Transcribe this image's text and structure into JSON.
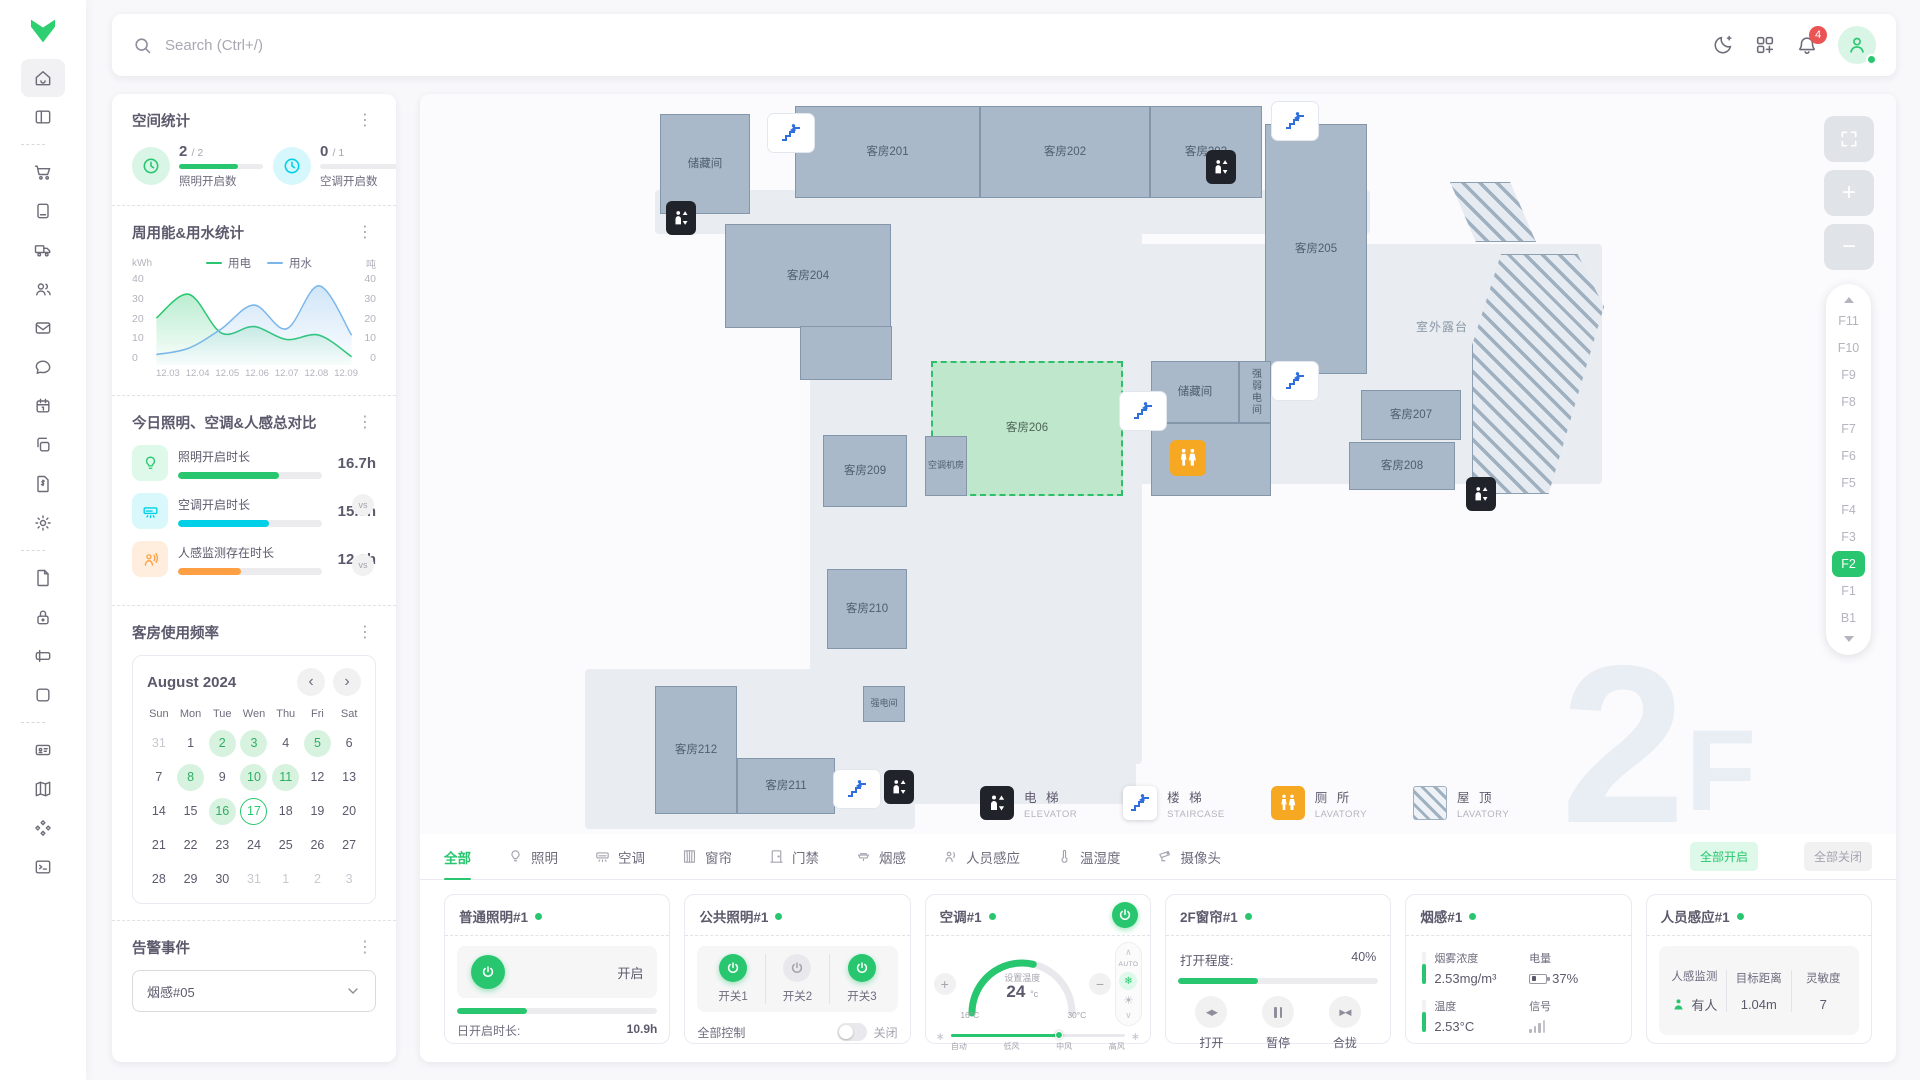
{
  "app": {
    "search_placeholder": "Search (Ctrl+/)",
    "notification_count": "4"
  },
  "sidebar": {
    "items": [
      {
        "icon": "home",
        "active": true
      },
      {
        "icon": "layout"
      },
      {
        "divider": true
      },
      {
        "icon": "cart"
      },
      {
        "icon": "book"
      },
      {
        "icon": "truck"
      },
      {
        "icon": "users"
      },
      {
        "icon": "mail"
      },
      {
        "icon": "chat"
      },
      {
        "icon": "calendar"
      },
      {
        "icon": "copy"
      },
      {
        "icon": "invoice"
      },
      {
        "icon": "gear"
      },
      {
        "divider": true
      },
      {
        "icon": "file"
      },
      {
        "icon": "lock"
      },
      {
        "icon": "input"
      },
      {
        "icon": "square"
      },
      {
        "divider": true
      },
      {
        "icon": "idcard"
      },
      {
        "icon": "map"
      },
      {
        "icon": "shapes"
      },
      {
        "icon": "terminal"
      }
    ]
  },
  "stats_panel": {
    "space_stats": {
      "title": "空间统计",
      "items": [
        {
          "value": "2",
          "denom": "/ 2",
          "label": "照明开启数",
          "color": "#28c76f",
          "pct": 70
        },
        {
          "value": "0",
          "denom": "/ 1",
          "label": "空调开启数",
          "color": "#00cfe8",
          "pct": 0
        }
      ]
    },
    "energy": {
      "title": "周用能&用水统计"
    },
    "compare": {
      "title": "今日照明、空调&人感总对比",
      "vs_label": "vs",
      "rows": [
        {
          "label": "照明开启时长",
          "value": "16.7h",
          "pct": 70,
          "color": "#28c76f",
          "icon": "bulb"
        },
        {
          "label": "空调开启时长",
          "value": "15.3h",
          "pct": 63,
          "color": "#00cfe8",
          "icon": "ac"
        },
        {
          "label": "人感监测存在时长",
          "value": "12.3h",
          "pct": 44,
          "color": "#ff9f43",
          "icon": "presence"
        }
      ]
    },
    "calendar": {
      "title": "客房使用频率",
      "month": "August 2024",
      "weekdays": [
        "Sun",
        "Mon",
        "Tue",
        "Wen",
        "Thu",
        "Fri",
        "Sat"
      ],
      "days": [
        {
          "n": "31",
          "s": "out"
        },
        {
          "n": "1"
        },
        {
          "n": "2",
          "s": "on"
        },
        {
          "n": "3",
          "s": "on"
        },
        {
          "n": "4"
        },
        {
          "n": "5",
          "s": "on"
        },
        {
          "n": "6"
        },
        {
          "n": "7"
        },
        {
          "n": "8",
          "s": "on"
        },
        {
          "n": "9"
        },
        {
          "n": "10",
          "s": "on"
        },
        {
          "n": "11",
          "s": "on"
        },
        {
          "n": "12"
        },
        {
          "n": "13"
        },
        {
          "n": "14"
        },
        {
          "n": "15"
        },
        {
          "n": "16",
          "s": "on"
        },
        {
          "n": "17",
          "s": "sel"
        },
        {
          "n": "18"
        },
        {
          "n": "19"
        },
        {
          "n": "20"
        },
        {
          "n": "21"
        },
        {
          "n": "22"
        },
        {
          "n": "23"
        },
        {
          "n": "24"
        },
        {
          "n": "25"
        },
        {
          "n": "26"
        },
        {
          "n": "27"
        },
        {
          "n": "28"
        },
        {
          "n": "29"
        },
        {
          "n": "30"
        },
        {
          "n": "31",
          "s": "out"
        },
        {
          "n": "1",
          "s": "out"
        },
        {
          "n": "2",
          "s": "out"
        },
        {
          "n": "3",
          "s": "out"
        }
      ]
    },
    "alarm": {
      "title": "告警事件",
      "selected": "烟感#05"
    }
  },
  "chart_data": {
    "type": "area",
    "title": "周用能&用水统计",
    "x": [
      "12.03",
      "12.04",
      "12.05",
      "12.06",
      "12.07",
      "12.08",
      "12.09"
    ],
    "series": [
      {
        "name": "用电",
        "color": "#28c76f",
        "values": [
          20,
          31,
          13,
          16,
          10,
          12,
          2
        ]
      },
      {
        "name": "用水",
        "color": "#7ab6ea",
        "values": [
          3,
          6,
          15,
          26,
          15,
          35,
          12
        ]
      }
    ],
    "ylabel_left": "kWh",
    "ylabel_right": "吨",
    "yticks": [
      0,
      10,
      20,
      30,
      40
    ],
    "ylim": [
      0,
      40
    ],
    "legend_position": "top",
    "grid": false
  },
  "map": {
    "rooms": [
      {
        "name": "储藏间"
      },
      {
        "name": "客房201"
      },
      {
        "name": "客房202"
      },
      {
        "name": "客房203"
      },
      {
        "name": "客房205"
      },
      {
        "name": "客房204"
      },
      {
        "name": "客房206",
        "selected": true
      },
      {
        "name": "空调机房",
        "small": true
      },
      {
        "name": "储藏间"
      },
      {
        "name": "强弱电间",
        "vertical": true
      },
      {
        "name": "客房207"
      },
      {
        "name": "客房208"
      },
      {
        "name": "客房209"
      },
      {
        "name": "客房210"
      },
      {
        "name": "强电间",
        "small": true
      },
      {
        "name": "客房212"
      },
      {
        "name": "客房211"
      }
    ],
    "outdoor_label": "室外露台",
    "watermark_big": "2",
    "watermark_small": "F",
    "zoom_in": "+",
    "zoom_out": "−",
    "legend": [
      {
        "type": "elevator",
        "zh": "电 梯",
        "en": "ELEVATOR"
      },
      {
        "type": "staircase",
        "zh": "楼 梯",
        "en": "STAIRCASE"
      },
      {
        "type": "lavatory",
        "zh": "厕 所",
        "en": "LAVATORY"
      },
      {
        "type": "roof",
        "zh": "屋 顶",
        "en": "LAVATORY"
      }
    ],
    "floors": [
      "F11",
      "F10",
      "F9",
      "F8",
      "F7",
      "F6",
      "F5",
      "F4",
      "F3",
      "F2",
      "F1",
      "B1"
    ],
    "active_floor": "F2"
  },
  "device_panel": {
    "tabs": [
      {
        "label": "全部",
        "icon": null,
        "active": true
      },
      {
        "label": "照明",
        "icon": "bulb"
      },
      {
        "label": "空调",
        "icon": "ac"
      },
      {
        "label": "窗帘",
        "icon": "curtain"
      },
      {
        "label": "门禁",
        "icon": "door"
      },
      {
        "label": "烟感",
        "icon": "smoke"
      },
      {
        "label": "人员感应",
        "icon": "presence"
      },
      {
        "label": "温湿度",
        "icon": "thermo"
      },
      {
        "label": "摄像头",
        "icon": "camera"
      }
    ],
    "all_on": "全部开启",
    "all_off": "全部关闭",
    "cards": {
      "c1": {
        "title": "普通照明#1",
        "state": "开启",
        "pct": 35,
        "color": "#28c76f",
        "duration_label": "日开启时长:",
        "duration": "10.9h"
      },
      "c2": {
        "title": "公共照明#1",
        "sw1": "开关1",
        "sw2": "开关2",
        "sw3": "开关3",
        "all_label": "全部控制",
        "toggle_state": "关闭"
      },
      "c3": {
        "title": "空调#1",
        "set_label": "设置温度",
        "temp": "24",
        "unit": "°c",
        "min_label": "16°C",
        "max_label": "30°C",
        "temp_min": 16,
        "temp_max": 30,
        "temp_set": 24,
        "auto_label": "AUTO",
        "fan_labels": [
          "自动",
          "低风",
          "中风",
          "高风"
        ],
        "fan_pct": 62
      },
      "c4": {
        "title": "2F窗帘#1",
        "open_label": "打开程度:",
        "open_value": "40%",
        "pct": 40,
        "color": "#28c76f",
        "btn_open": "打开",
        "btn_pause": "暂停",
        "btn_close": "合拢"
      },
      "c5": {
        "title": "烟感#1",
        "m1_label": "烟雾浓度",
        "m1": "2.53mg/m³",
        "m2_label": "电量",
        "m2": "37%",
        "m3_label": "温度",
        "m3": "2.53°C",
        "m4_label": "信号"
      },
      "c6": {
        "title": "人员感应#1",
        "c1_label": "人感监测",
        "c1": "有人",
        "c2_label": "目标距离",
        "c2": "1.04m",
        "c3_label": "灵敏度",
        "c3": "7"
      }
    }
  }
}
